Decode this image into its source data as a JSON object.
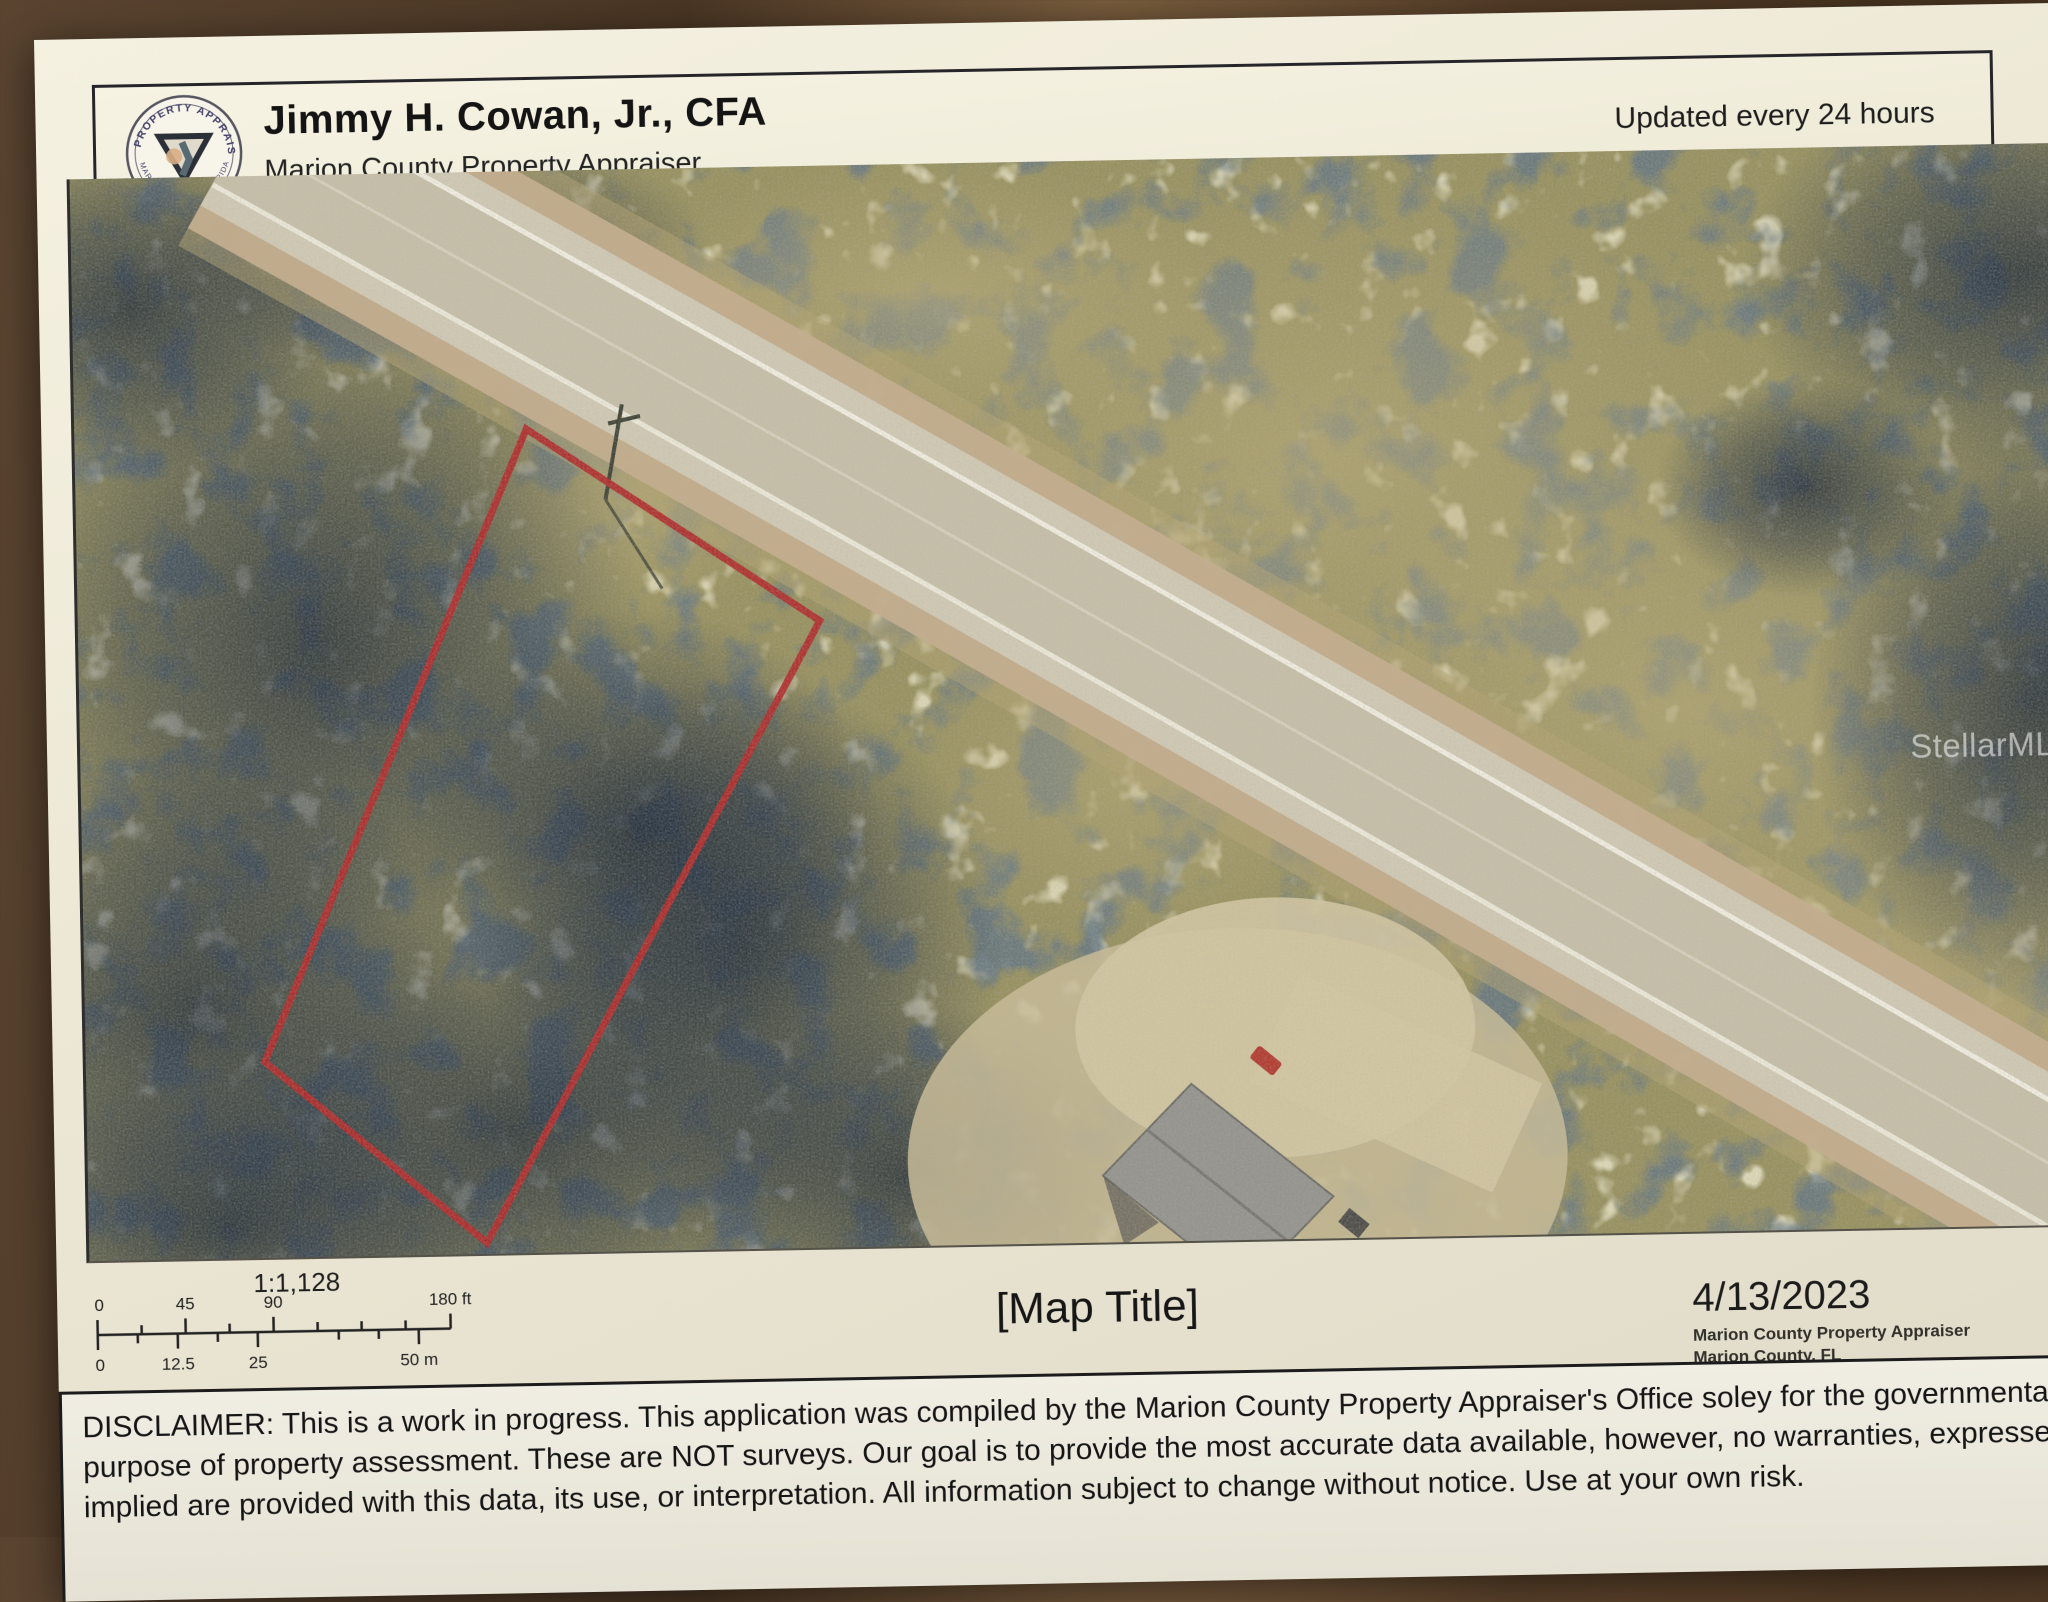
{
  "header": {
    "name": "Jimmy H. Cowan, Jr., CFA",
    "subtitle": "Marion County Property Appraiser",
    "updated": "Updated every 24 hours",
    "seal_top": "PROPERTY APPRAISER",
    "seal_bottom": "MARION COUNTY, FLORIDA"
  },
  "map": {
    "watermark": "StellarMLS",
    "parcel_outline_color": "#b02c2c"
  },
  "scale": {
    "ratio": "1:1,128",
    "feet_labels": [
      "0",
      "45",
      "90",
      "180 ft"
    ],
    "meter_labels": [
      "0",
      "12.5",
      "25",
      "50 m"
    ]
  },
  "footer": {
    "map_title": "[Map Title]",
    "date": "4/13/2023",
    "attribution1": "Marion County Property Appraiser",
    "attribution2": "Marion County, FL"
  },
  "disclaimer": {
    "lines": [
      "DISCLAIMER: This is a work in progress. This application was compiled by the Marion County Property Appraiser's Office soley for the governmental",
      "purpose of property assessment. These are NOT surveys. Our goal is to provide the most accurate data available, however, no warranties, expressed or",
      "implied are provided with this data, its use, or interpretation. All information subject to change without notice. Use at your own risk."
    ]
  }
}
